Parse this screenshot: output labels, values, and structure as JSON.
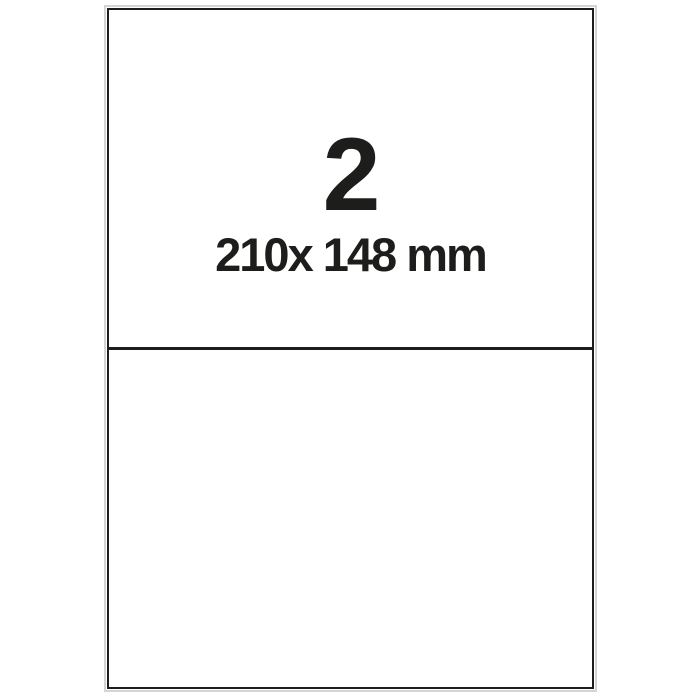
{
  "sheet": {
    "label_count": "2",
    "label_size": "210x 148 mm",
    "labels_per_sheet": 2
  },
  "colors": {
    "ink": "#1d1d1b",
    "paper-edge": "#d4d4d2",
    "paper": "#ffffff"
  }
}
